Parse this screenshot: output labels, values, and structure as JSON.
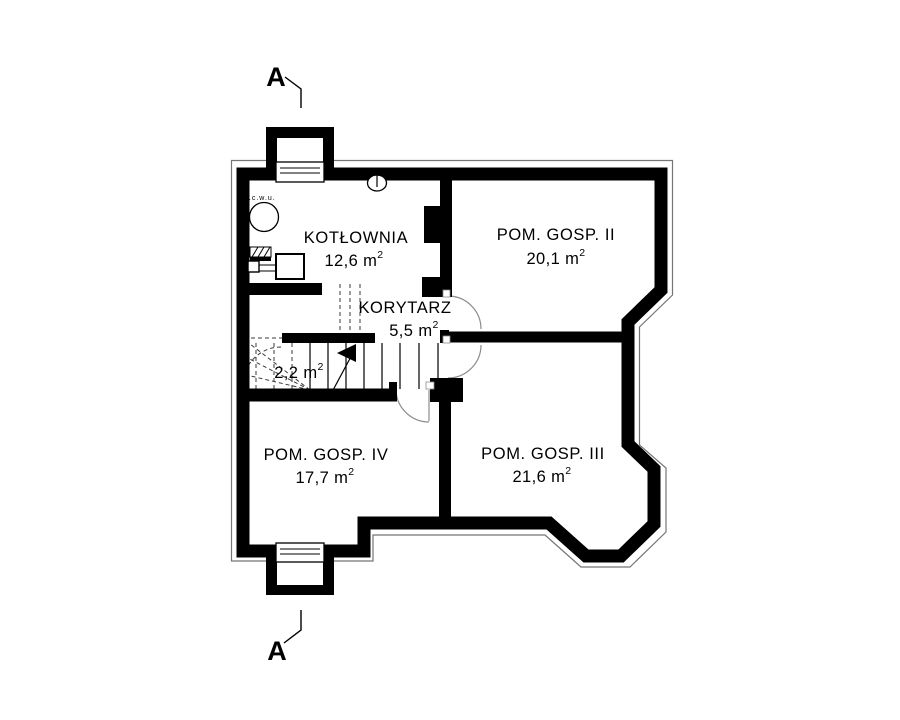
{
  "floorplan": {
    "section_marker_top": "A",
    "section_marker_bottom": "A",
    "water_heater_label": "p.c.w.u.",
    "rooms": {
      "kotlownia": {
        "name": "KOTŁOWNIA",
        "area": "12,6 m",
        "area_sup": "2"
      },
      "pom_gosp_ii": {
        "name": "POM. GOSP. II",
        "area": "20,1 m",
        "area_sup": "2"
      },
      "korytarz": {
        "name": "KORYTARZ",
        "area": "5,5 m",
        "area_sup": "2"
      },
      "schody": {
        "area": "2,2 m",
        "area_sup": "2"
      },
      "pom_gosp_iv": {
        "name": "POM. GOSP. IV",
        "area": "17,7 m",
        "area_sup": "2"
      },
      "pom_gosp_iii": {
        "name": "POM. GOSP. III",
        "area": "21,6 m",
        "area_sup": "2"
      }
    },
    "colors": {
      "wall": "#000000",
      "outline": "#757575",
      "door_arc": "#8c8c8c",
      "dashed": "#3a3a3a",
      "background": "#ffffff"
    }
  }
}
